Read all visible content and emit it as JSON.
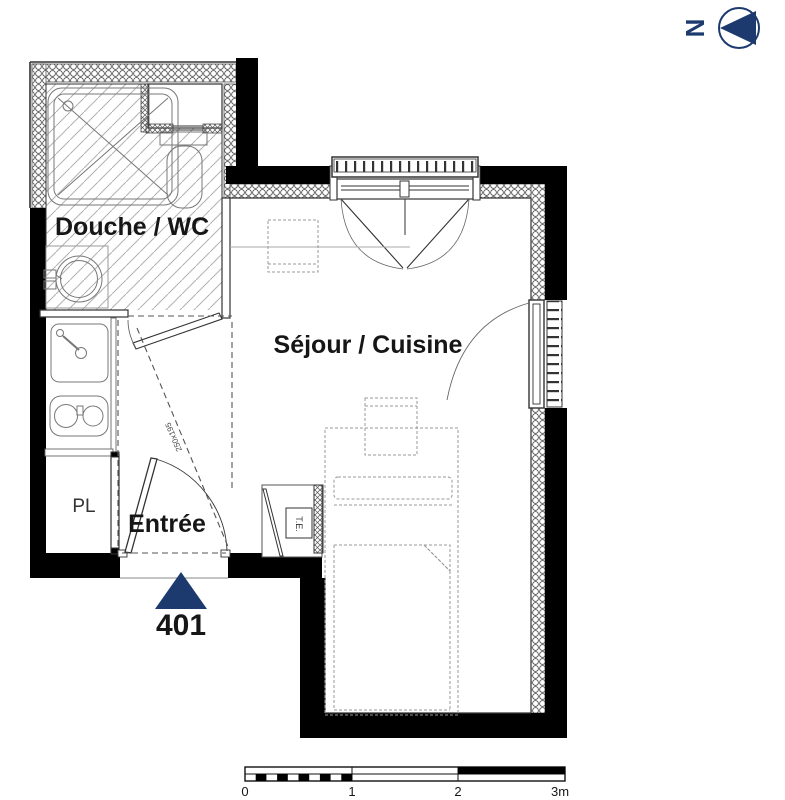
{
  "colors": {
    "accent": "#1c3a6e",
    "wall": "#000000",
    "furniture_line": "#999999"
  },
  "north_indicator": {
    "label": "N"
  },
  "rooms": {
    "bathroom": {
      "label": "Douche / WC"
    },
    "living": {
      "label": "Séjour / Cuisine"
    },
    "entry": {
      "label": "Entrée"
    },
    "closet": {
      "label": "PL"
    }
  },
  "annotations": {
    "electrical_panel": "T.E.",
    "entry_clearance": "250x195",
    "unit_number": "401"
  },
  "scale_bar": {
    "ticks": [
      "0",
      "1",
      "2",
      "3m"
    ]
  }
}
